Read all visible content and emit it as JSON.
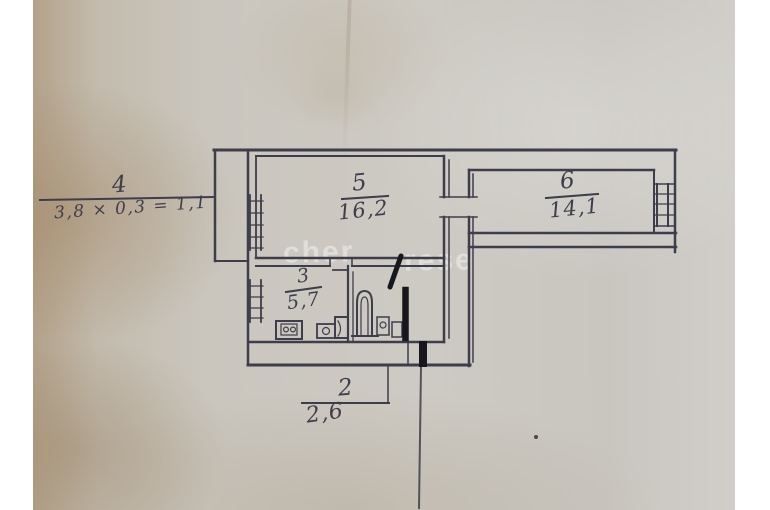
{
  "plan": {
    "rooms": [
      {
        "id": "balcony",
        "number": "4",
        "formula": "3,8 × 0,3 = 1,1"
      },
      {
        "id": "room-5",
        "number": "5",
        "area": "16,2"
      },
      {
        "id": "room-6",
        "number": "6",
        "area": "14,1"
      },
      {
        "id": "kitchen",
        "number": "3",
        "area": "5,7"
      },
      {
        "id": "bathroom",
        "number": "2",
        "area": "2,6"
      }
    ],
    "pen_marks": [
      "diagonal-stroke",
      "vertical-stroke",
      "doorway-fill"
    ]
  },
  "watermark": {
    "frag1": "cher",
    "frag2": "rese"
  },
  "colors": {
    "ink": "#3e3d4b",
    "bold_ink": "#17171d",
    "paper_base": "#c8c5bd",
    "page_white": "#ffffff"
  }
}
